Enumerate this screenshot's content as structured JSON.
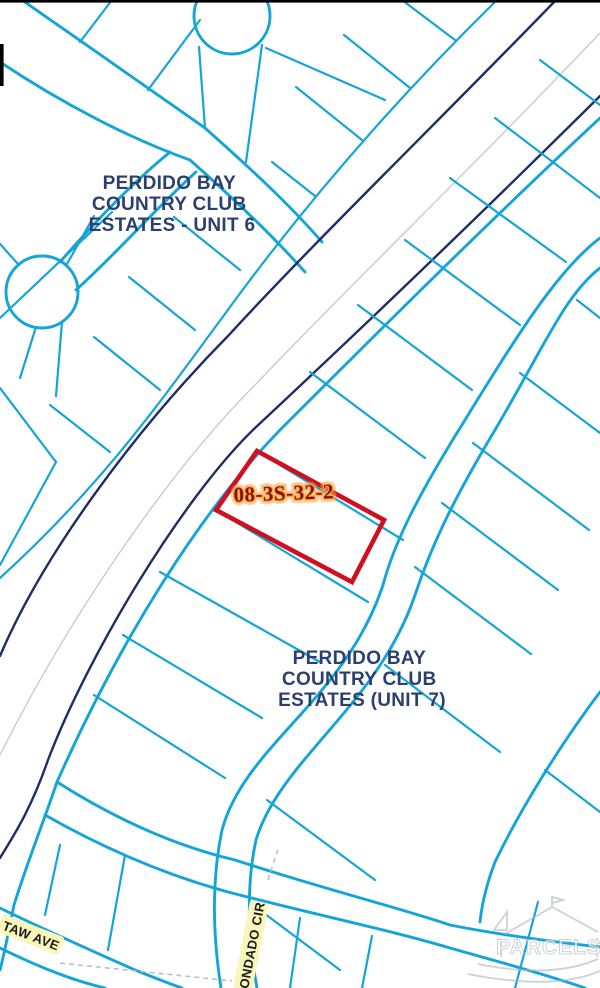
{
  "window": {
    "width": 600,
    "height": 988
  },
  "map": {
    "type": "parcel-gis-map",
    "region_labels": [
      {
        "id": "unit6",
        "lines": [
          "PERDIDO BAY",
          "COUNTRY CLUB",
          "ESTATES - UNIT 6"
        ]
      },
      {
        "id": "unit7",
        "lines": [
          "PERDIDO BAY",
          "COUNTRY CLUB",
          "ESTATES (UNIT 7)"
        ]
      }
    ],
    "selected_parcel": {
      "id": "08-3S-32-2"
    },
    "street_labels": [
      {
        "name": "TAW AVE"
      },
      {
        "name": "ONDADO CIR"
      }
    ],
    "watermark_text": "PARCELS",
    "colors": {
      "parcel_line": "#14A5D8",
      "road_casing": "#1E2D63",
      "road_centerline": "#C7CCD2",
      "selection": "#D01020",
      "region_label": "#2B406E",
      "parcel_id_text": "#7E1403",
      "parcel_id_glow": "#FFA042",
      "street_label_bg": "#FAF5BB",
      "street_label_text": "#1A1A1A",
      "watermark": "#AEB6BD",
      "background": "#FFFFFF"
    }
  }
}
